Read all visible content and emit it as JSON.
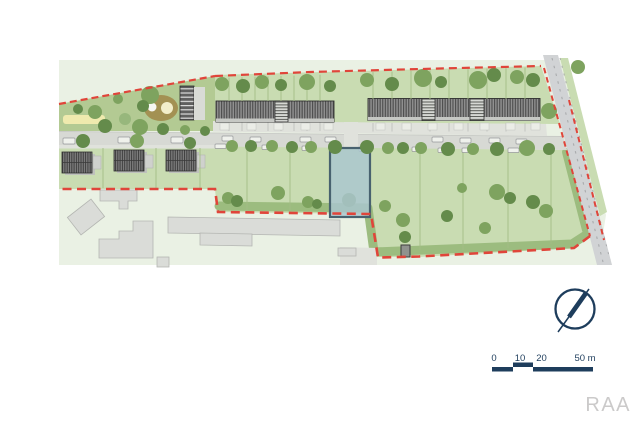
{
  "page": {
    "watermark": "RAA"
  },
  "icons": {
    "north_arrow": "compass-circle-with-needle"
  },
  "colors": {
    "page_bg": "#ffffff",
    "context_green": "#eaf1e4",
    "plot_green": "#c9dcb2",
    "wedge_green": "#b3ca93",
    "hedge_green": "#9cbc7f",
    "street_gray": "#d7d9d4",
    "sidewalk_gray": "#e0e2dc",
    "road_gray": "#d1d3d5",
    "road_mark": "#a9abad",
    "bldg_gray": "#dadcd8",
    "bldg_stroke": "#b4b6b2",
    "boundary_red": "#e0453a",
    "blue_fill": "#a9c6cf",
    "blue_stroke": "#48626f",
    "navy": "#1e3d5c",
    "watermark_gray": "#cbcaca",
    "yellow_strip": "#efeaae",
    "olive": "#a39153",
    "olive_light": "#f3eeca",
    "tree_dark": "#648b4b",
    "tree_mid": "#7ea35f",
    "tree_light": "#97b77c",
    "car_fill": "#eff1ec",
    "car_stroke": "#96989a",
    "plot_line_green": "#a3bc86",
    "plot_line_light": "#bfc1bc",
    "pad_fill": "#ebede7",
    "shed_fill": "#90928e"
  },
  "scale_bar": {
    "label_y": 361,
    "labels": [
      {
        "t": "0",
        "x": 494
      },
      {
        "t": "10",
        "x": 520
      },
      {
        "t": "20",
        "x": 541.5
      },
      {
        "t": "50 m",
        "x": 585
      }
    ],
    "segments": [
      [
        492,
        367,
        21,
        4.5
      ],
      [
        513,
        362.5,
        20,
        4.5
      ],
      [
        533,
        367,
        60,
        4.5
      ]
    ]
  },
  "map": {
    "tree_shades": [
      "tree_dark",
      "tree_mid",
      "tree_light"
    ],
    "trees": [
      [
        150,
        95,
        9,
        1
      ],
      [
        143,
        106,
        6,
        0
      ],
      [
        118,
        99,
        5,
        1
      ],
      [
        95,
        112,
        7,
        1
      ],
      [
        78,
        109,
        5,
        0
      ],
      [
        105,
        126,
        7,
        0
      ],
      [
        125,
        119,
        6,
        2
      ],
      [
        140,
        127,
        8,
        1
      ],
      [
        163,
        129,
        6,
        0
      ],
      [
        185,
        130,
        5,
        1
      ],
      [
        205,
        131,
        5,
        0
      ],
      [
        222,
        84,
        7,
        1
      ],
      [
        243,
        86,
        7,
        0
      ],
      [
        262,
        82,
        7,
        1
      ],
      [
        281,
        85,
        6,
        0
      ],
      [
        307,
        82,
        8,
        1
      ],
      [
        330,
        86,
        6,
        0
      ],
      [
        367,
        80,
        7,
        1
      ],
      [
        392,
        84,
        7,
        0
      ],
      [
        423,
        78,
        9,
        1
      ],
      [
        441,
        82,
        6,
        0
      ],
      [
        478,
        80,
        9,
        1
      ],
      [
        494,
        75,
        7,
        0
      ],
      [
        517,
        77,
        7,
        1
      ],
      [
        533,
        80,
        7,
        0
      ],
      [
        549,
        111,
        8,
        1
      ],
      [
        578,
        67,
        7,
        1
      ],
      [
        83,
        141,
        7,
        0
      ],
      [
        137,
        141,
        7,
        1
      ],
      [
        190,
        143,
        6,
        0
      ],
      [
        232,
        146,
        6,
        1
      ],
      [
        251,
        146,
        6,
        0
      ],
      [
        272,
        146,
        6,
        1
      ],
      [
        292,
        147,
        6,
        0
      ],
      [
        311,
        147,
        6,
        1
      ],
      [
        335,
        147,
        7,
        0
      ],
      [
        367,
        147,
        7,
        0
      ],
      [
        388,
        148,
        6,
        1
      ],
      [
        403,
        148,
        6,
        0
      ],
      [
        421,
        148,
        6,
        1
      ],
      [
        448,
        149,
        7,
        0
      ],
      [
        473,
        149,
        6,
        1
      ],
      [
        497,
        149,
        7,
        0
      ],
      [
        527,
        148,
        8,
        1
      ],
      [
        549,
        149,
        6,
        0
      ],
      [
        228,
        198,
        6,
        1
      ],
      [
        237,
        201,
        6,
        0
      ],
      [
        278,
        193,
        7,
        1
      ],
      [
        308,
        202,
        6,
        1
      ],
      [
        317,
        204,
        5,
        0
      ],
      [
        385,
        206,
        6,
        1
      ],
      [
        403,
        220,
        7,
        1
      ],
      [
        405,
        237,
        6,
        0
      ],
      [
        447,
        216,
        6,
        0
      ],
      [
        462,
        188,
        5,
        1
      ],
      [
        485,
        228,
        6,
        1
      ],
      [
        497,
        192,
        8,
        1
      ],
      [
        510,
        198,
        6,
        0
      ],
      [
        533,
        202,
        7,
        0
      ],
      [
        546,
        211,
        7,
        1
      ]
    ],
    "cars": [
      [
        63,
        138,
        12,
        6
      ],
      [
        118,
        137,
        12,
        6
      ],
      [
        171,
        137,
        12,
        6
      ],
      [
        222,
        136,
        11,
        5
      ],
      [
        250,
        137,
        11,
        5
      ],
      [
        300,
        137,
        11,
        5
      ],
      [
        325,
        137,
        11,
        5
      ],
      [
        432,
        137,
        11,
        5
      ],
      [
        460,
        138,
        11,
        5
      ],
      [
        489,
        138,
        11,
        5
      ],
      [
        516,
        139,
        11,
        5
      ],
      [
        215,
        144,
        11,
        4.5
      ],
      [
        262,
        145,
        11,
        4.5
      ],
      [
        302,
        146,
        11,
        4.5
      ],
      [
        359,
        147,
        11,
        4.5
      ],
      [
        412,
        147,
        11,
        4.5
      ],
      [
        438,
        148,
        11,
        4.5
      ],
      [
        462,
        148,
        11,
        4.5
      ],
      [
        508,
        148,
        11,
        4.5
      ]
    ],
    "pads": [
      [
        220,
        123,
        9,
        7
      ],
      [
        247,
        123,
        9,
        7
      ],
      [
        274,
        123,
        9,
        7
      ],
      [
        301,
        123,
        9,
        7
      ],
      [
        324,
        123,
        9,
        7
      ],
      [
        376,
        123,
        9,
        7
      ],
      [
        402,
        123,
        9,
        7
      ],
      [
        428,
        123,
        9,
        7
      ],
      [
        454,
        123,
        9,
        7
      ],
      [
        480,
        123,
        9,
        7
      ],
      [
        506,
        123,
        9,
        7
      ],
      [
        531,
        123,
        9,
        7
      ]
    ],
    "plot_lines": {
      "green": [
        [
          229,
          77.6,
          101
        ],
        [
          242,
          77.2,
          101
        ],
        [
          255,
          76.8,
          101
        ],
        [
          268,
          76.4,
          101
        ],
        [
          281,
          76.0,
          101
        ],
        [
          294,
          75.6,
          101
        ],
        [
          307,
          75.2,
          101
        ],
        [
          320,
          74.8,
          101
        ],
        [
          373,
          72.1,
          99
        ],
        [
          392,
          71.6,
          99
        ],
        [
          411,
          71.0,
          99
        ],
        [
          430,
          70.4,
          99
        ],
        [
          449,
          69.8,
          99
        ],
        [
          468,
          69.2,
          99
        ],
        [
          487,
          68.6,
          99
        ],
        [
          506,
          68.1,
          99
        ],
        [
          525,
          67.5,
          99
        ],
        [
          103,
          148,
          188
        ],
        [
          156,
          148,
          188
        ],
        [
          200,
          148,
          188
        ],
        [
          247,
          148,
          210
        ],
        [
          290,
          148,
          212
        ],
        [
          420,
          150,
          250
        ],
        [
          463,
          151,
          250
        ],
        [
          508,
          152,
          248
        ],
        [
          551,
          153,
          244
        ]
      ],
      "light": [
        [
          229,
          122.5,
          131
        ],
        [
          242,
          122.5,
          131
        ],
        [
          255,
          122.5,
          131
        ],
        [
          268,
          122.5,
          131
        ],
        [
          281,
          122.5,
          131
        ],
        [
          294,
          122.5,
          131
        ],
        [
          307,
          122.5,
          131
        ],
        [
          320,
          122.5,
          131
        ],
        [
          373,
          123,
          131.5
        ],
        [
          392,
          123,
          131.5
        ],
        [
          411,
          123,
          131.5
        ],
        [
          430,
          123,
          131.5
        ],
        [
          449,
          123,
          131.5
        ],
        [
          468,
          123,
          131.5
        ],
        [
          487,
          123,
          131.5
        ],
        [
          506,
          123,
          131.5
        ],
        [
          525,
          123,
          131.5
        ]
      ]
    },
    "blue_plot": {
      "x": 330,
      "y": 148,
      "w": 40,
      "h": 69,
      "tree": [
        349,
        200,
        7
      ]
    }
  }
}
